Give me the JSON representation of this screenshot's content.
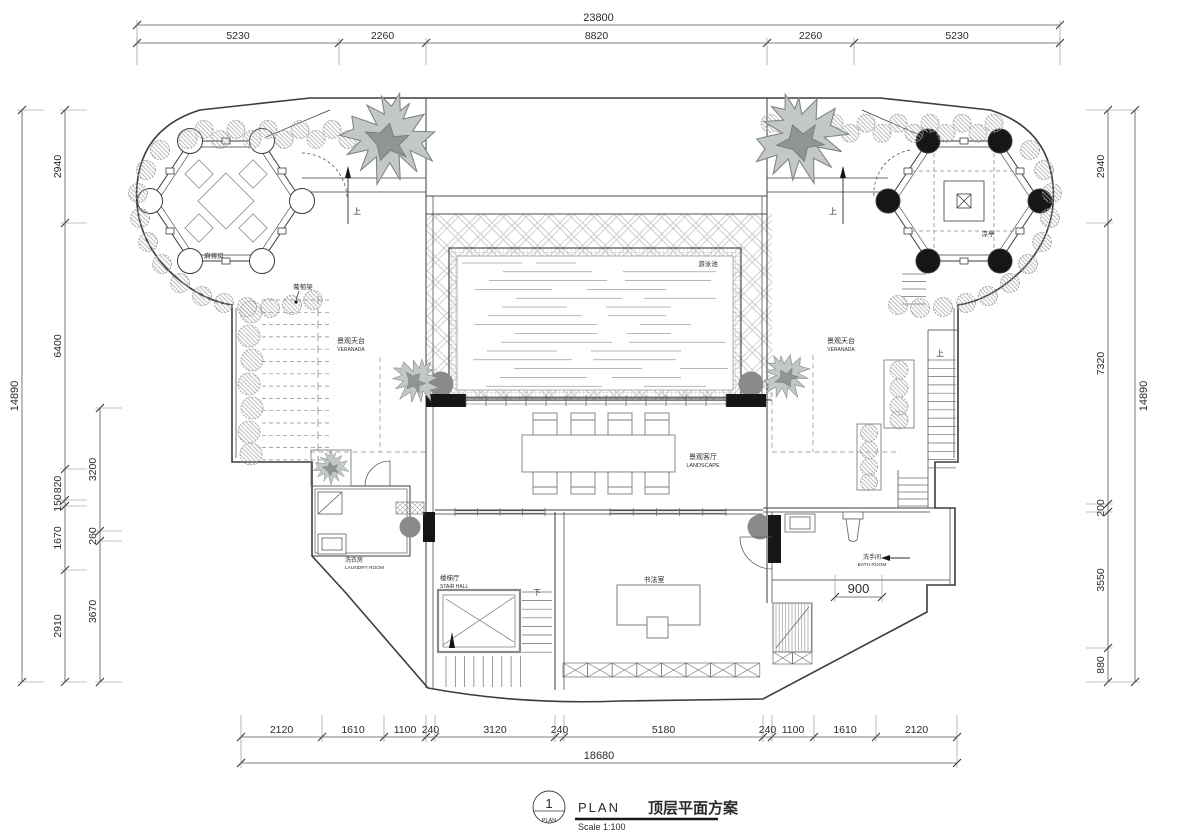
{
  "title_block": {
    "number": "1",
    "bubble_caption": "PLAN",
    "name": "PLAN",
    "title_cn": "顶层平面方案",
    "scale": "Scale 1:100"
  },
  "dimensions": {
    "top": {
      "total": "23800",
      "segments": [
        "5230",
        "2260",
        "8820",
        "2260",
        "5230"
      ]
    },
    "bottom": {
      "total": "18680",
      "segments": [
        "2120",
        "1610",
        "1100",
        "240",
        "3120",
        "240",
        "5180",
        "240",
        "1100",
        "1610",
        "2120"
      ]
    },
    "left": {
      "total": "14890",
      "chain_outer": [
        "2940",
        "6400",
        "820",
        "150",
        "1670",
        "2910"
      ],
      "chain_inner": [
        "3200",
        "260",
        "3670"
      ]
    },
    "right": {
      "total": "14890",
      "chain": [
        "2940",
        "7320",
        "200",
        "3550",
        "880"
      ]
    },
    "extra": {
      "bath_stair": "900"
    }
  },
  "rooms": {
    "pavilion_left": {
      "cn": "麻将房"
    },
    "pavilion_right": {
      "cn": "凉亭"
    },
    "trellis": {
      "cn": "葡萄架"
    },
    "veranda_left": {
      "cn": "景观天台",
      "en": "VERANADA"
    },
    "veranda_right": {
      "cn": "景观天台",
      "en": "VERANADA"
    },
    "pool": {
      "cn": "游泳池"
    },
    "living": {
      "cn": "景观客厅",
      "en": "LANDSCAPE"
    },
    "laundry": {
      "cn": "洗衣房",
      "en": "LAUNDRY ROOM"
    },
    "stair_hall": {
      "cn": "楼梯厅",
      "en": "STAIR HALL"
    },
    "calligraphy": {
      "cn": "书法室"
    },
    "bath": {
      "cn": "洗手间",
      "en": "BATH ROOM"
    }
  },
  "markers": {
    "up": "上",
    "down": "下"
  },
  "colors": {
    "line": "#3c3c3c",
    "grey_column": "#8a8a8a",
    "black_column": "#161616",
    "hatch": "#c9c9c9",
    "water": "#9aa0a0"
  }
}
